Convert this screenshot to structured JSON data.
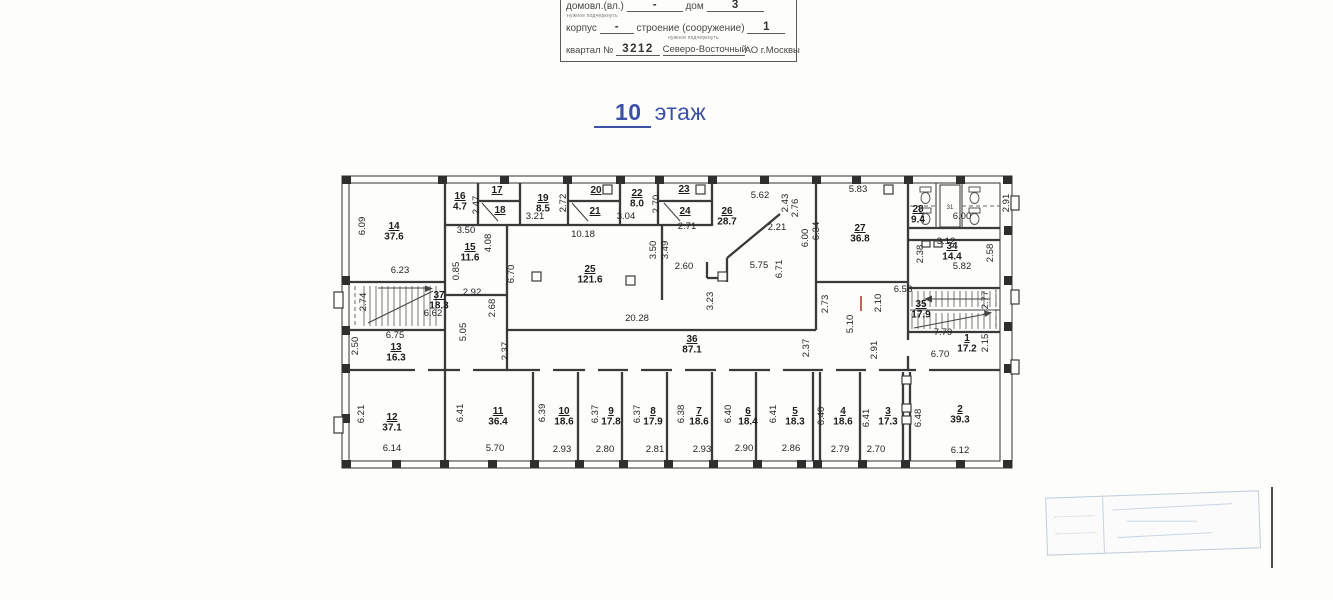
{
  "form": {
    "row1": {
      "label1": "домовл.(вл.)",
      "value1": "-",
      "label2": "дом",
      "value2": "3",
      "note": "нужное подчеркнуть"
    },
    "row2": {
      "label1": "корпус",
      "value1": "-",
      "label2": "строение (сооружение)",
      "value2": "1",
      "note": "нужное подчеркнуть"
    },
    "row3": {
      "label": "квартал №",
      "value": "3212",
      "okrug": "Северо-Восточный",
      "suffix": "АО г.Москвы"
    }
  },
  "title": {
    "number": "10",
    "word": "этаж"
  },
  "colors": {
    "title_blue": "#3c51a6",
    "red_mark": "#c03830",
    "line": "#3a3a3a"
  },
  "plan": {
    "rooms": [
      {
        "num": "1",
        "area": "17.2",
        "x": 967,
        "y": 341
      },
      {
        "num": "2",
        "area": "39.3",
        "x": 960,
        "y": 412
      },
      {
        "num": "3",
        "area": "17.3",
        "x": 888,
        "y": 414
      },
      {
        "num": "4",
        "area": "18.6",
        "x": 843,
        "y": 414
      },
      {
        "num": "5",
        "area": "18.3",
        "x": 795,
        "y": 414
      },
      {
        "num": "6",
        "area": "18.4",
        "x": 748,
        "y": 414
      },
      {
        "num": "7",
        "area": "18.6",
        "x": 699,
        "y": 414
      },
      {
        "num": "8",
        "area": "17.9",
        "x": 653,
        "y": 414
      },
      {
        "num": "9",
        "area": "17.8",
        "x": 611,
        "y": 414
      },
      {
        "num": "10",
        "area": "18.6",
        "x": 564,
        "y": 414
      },
      {
        "num": "11",
        "area": "36.4",
        "x": 498,
        "y": 414
      },
      {
        "num": "12",
        "area": "37.1",
        "x": 392,
        "y": 420
      },
      {
        "num": "13",
        "area": "16.3",
        "x": 396,
        "y": 350
      },
      {
        "num": "14",
        "area": "37.6",
        "x": 394,
        "y": 229
      },
      {
        "num": "15",
        "area": "11.6",
        "x": 470,
        "y": 250
      },
      {
        "num": "16",
        "area": "4.7",
        "x": 460,
        "y": 199
      },
      {
        "num": "17",
        "x": 497,
        "y": 193
      },
      {
        "num": "18",
        "x": 500,
        "y": 213
      },
      {
        "num": "19",
        "area": "8.5",
        "x": 543,
        "y": 201
      },
      {
        "num": "20",
        "x": 596,
        "y": 193
      },
      {
        "num": "21",
        "x": 595,
        "y": 214
      },
      {
        "num": "22",
        "area": "8.0",
        "x": 637,
        "y": 196
      },
      {
        "num": "23",
        "x": 684,
        "y": 192
      },
      {
        "num": "24",
        "x": 685,
        "y": 214
      },
      {
        "num": "25",
        "area": "121.6",
        "x": 590,
        "y": 272
      },
      {
        "num": "26",
        "area": "28.7",
        "x": 727,
        "y": 214
      },
      {
        "num": "27",
        "area": "36.8",
        "x": 860,
        "y": 231
      },
      {
        "num": "28",
        "area": "9.4",
        "x": 918,
        "y": 212
      },
      {
        "num": "34",
        "area": "14.4",
        "x": 952,
        "y": 249
      },
      {
        "num": "35",
        "area": "17.9",
        "x": 921,
        "y": 307
      },
      {
        "num": "36",
        "area": "87.1",
        "x": 692,
        "y": 342
      },
      {
        "num": "37",
        "area": "18.3",
        "x": 439,
        "y": 298
      }
    ],
    "dims": [
      {
        "t": "6.09",
        "x": 365,
        "y": 226,
        "v": true
      },
      {
        "t": "6.23",
        "x": 400,
        "y": 273
      },
      {
        "t": "2.47",
        "x": 479,
        "y": 205,
        "v": true
      },
      {
        "t": "2.72",
        "x": 566,
        "y": 203,
        "v": true
      },
      {
        "t": "3.21",
        "x": 535,
        "y": 219
      },
      {
        "t": "3.50",
        "x": 466,
        "y": 233
      },
      {
        "t": "4.08",
        "x": 491,
        "y": 243,
        "v": true
      },
      {
        "t": "0.85",
        "x": 459,
        "y": 271,
        "v": true
      },
      {
        "t": "6.70",
        "x": 514,
        "y": 274,
        "v": true
      },
      {
        "t": "10.18",
        "x": 583,
        "y": 237
      },
      {
        "t": "3.04",
        "x": 626,
        "y": 219
      },
      {
        "t": "2.70",
        "x": 659,
        "y": 204,
        "v": true
      },
      {
        "t": "2.71",
        "x": 687,
        "y": 229
      },
      {
        "t": "5.62",
        "x": 760,
        "y": 198
      },
      {
        "t": "2.43",
        "x": 788,
        "y": 203,
        "v": true
      },
      {
        "t": "2.76",
        "x": 798,
        "y": 208,
        "v": true
      },
      {
        "t": "2.21",
        "x": 777,
        "y": 230
      },
      {
        "t": "2.60",
        "x": 684,
        "y": 269
      },
      {
        "t": "3.50",
        "x": 656,
        "y": 250,
        "v": true
      },
      {
        "t": "3.49",
        "x": 668,
        "y": 250,
        "v": true
      },
      {
        "t": "5.75",
        "x": 759,
        "y": 268
      },
      {
        "t": "6.71",
        "x": 782,
        "y": 269,
        "v": true
      },
      {
        "t": "5.83",
        "x": 858,
        "y": 192
      },
      {
        "t": "6.34",
        "x": 819,
        "y": 231,
        "v": true
      },
      {
        "t": "6.00",
        "x": 808,
        "y": 238,
        "v": true
      },
      {
        "t": "2.91",
        "x": 1009,
        "y": 203,
        "v": true
      },
      {
        "t": "6.00",
        "x": 962,
        "y": 219
      },
      {
        "t": "3.12",
        "x": 946,
        "y": 244
      },
      {
        "t": "2.38",
        "x": 923,
        "y": 254,
        "v": true
      },
      {
        "t": "2.58",
        "x": 993,
        "y": 253,
        "v": true
      },
      {
        "t": "5.82",
        "x": 962,
        "y": 269
      },
      {
        "t": "2.92",
        "x": 472,
        "y": 295
      },
      {
        "t": "2.68",
        "x": 495,
        "y": 308,
        "v": true
      },
      {
        "t": "5.05",
        "x": 466,
        "y": 332,
        "v": true
      },
      {
        "t": "2.74",
        "x": 366,
        "y": 302,
        "v": true
      },
      {
        "t": "6.62",
        "x": 433,
        "y": 316
      },
      {
        "t": "2.50",
        "x": 358,
        "y": 346,
        "v": true
      },
      {
        "t": "6.75",
        "x": 395,
        "y": 338
      },
      {
        "t": "2.37",
        "x": 508,
        "y": 351,
        "v": true
      },
      {
        "t": "20.28",
        "x": 637,
        "y": 321
      },
      {
        "t": "3.23",
        "x": 713,
        "y": 301,
        "v": true
      },
      {
        "t": "2.73",
        "x": 828,
        "y": 304,
        "v": true
      },
      {
        "t": "2.10",
        "x": 881,
        "y": 303,
        "v": true
      },
      {
        "t": "5.10",
        "x": 853,
        "y": 324,
        "v": true
      },
      {
        "t": "6.58",
        "x": 903,
        "y": 292
      },
      {
        "t": "2.77",
        "x": 988,
        "y": 300,
        "v": true
      },
      {
        "t": "7.79",
        "x": 943,
        "y": 335
      },
      {
        "t": "2.91",
        "x": 877,
        "y": 350,
        "v": true
      },
      {
        "t": "2.15",
        "x": 988,
        "y": 343,
        "v": true
      },
      {
        "t": "6.70",
        "x": 940,
        "y": 357
      },
      {
        "t": "2.37",
        "x": 809,
        "y": 348,
        "v": true
      },
      {
        "t": "6.21",
        "x": 364,
        "y": 414,
        "v": true
      },
      {
        "t": "6.14",
        "x": 392,
        "y": 451
      },
      {
        "t": "6.41",
        "x": 463,
        "y": 413,
        "v": true
      },
      {
        "t": "5.70",
        "x": 495,
        "y": 451
      },
      {
        "t": "6.39",
        "x": 545,
        "y": 413,
        "v": true
      },
      {
        "t": "2.93",
        "x": 562,
        "y": 452
      },
      {
        "t": "6.37",
        "x": 598,
        "y": 414,
        "v": true
      },
      {
        "t": "2.80",
        "x": 605,
        "y": 452
      },
      {
        "t": "6.37",
        "x": 640,
        "y": 414,
        "v": true
      },
      {
        "t": "2.81",
        "x": 655,
        "y": 452
      },
      {
        "t": "6.38",
        "x": 684,
        "y": 414,
        "v": true
      },
      {
        "t": "2.93",
        "x": 702,
        "y": 452
      },
      {
        "t": "6.40",
        "x": 731,
        "y": 414,
        "v": true
      },
      {
        "t": "2.90",
        "x": 744,
        "y": 451
      },
      {
        "t": "6.41",
        "x": 776,
        "y": 414,
        "v": true
      },
      {
        "t": "2.86",
        "x": 791,
        "y": 451
      },
      {
        "t": "6.40",
        "x": 824,
        "y": 416,
        "v": true
      },
      {
        "t": "2.79",
        "x": 840,
        "y": 452
      },
      {
        "t": "6.41",
        "x": 869,
        "y": 418,
        "v": true
      },
      {
        "t": "2.70",
        "x": 876,
        "y": 452
      },
      {
        "t": "6.48",
        "x": 921,
        "y": 418,
        "v": true
      },
      {
        "t": "6.12",
        "x": 960,
        "y": 453
      }
    ],
    "small_labels": [
      {
        "t": "31",
        "x": 950,
        "y": 209
      }
    ]
  }
}
